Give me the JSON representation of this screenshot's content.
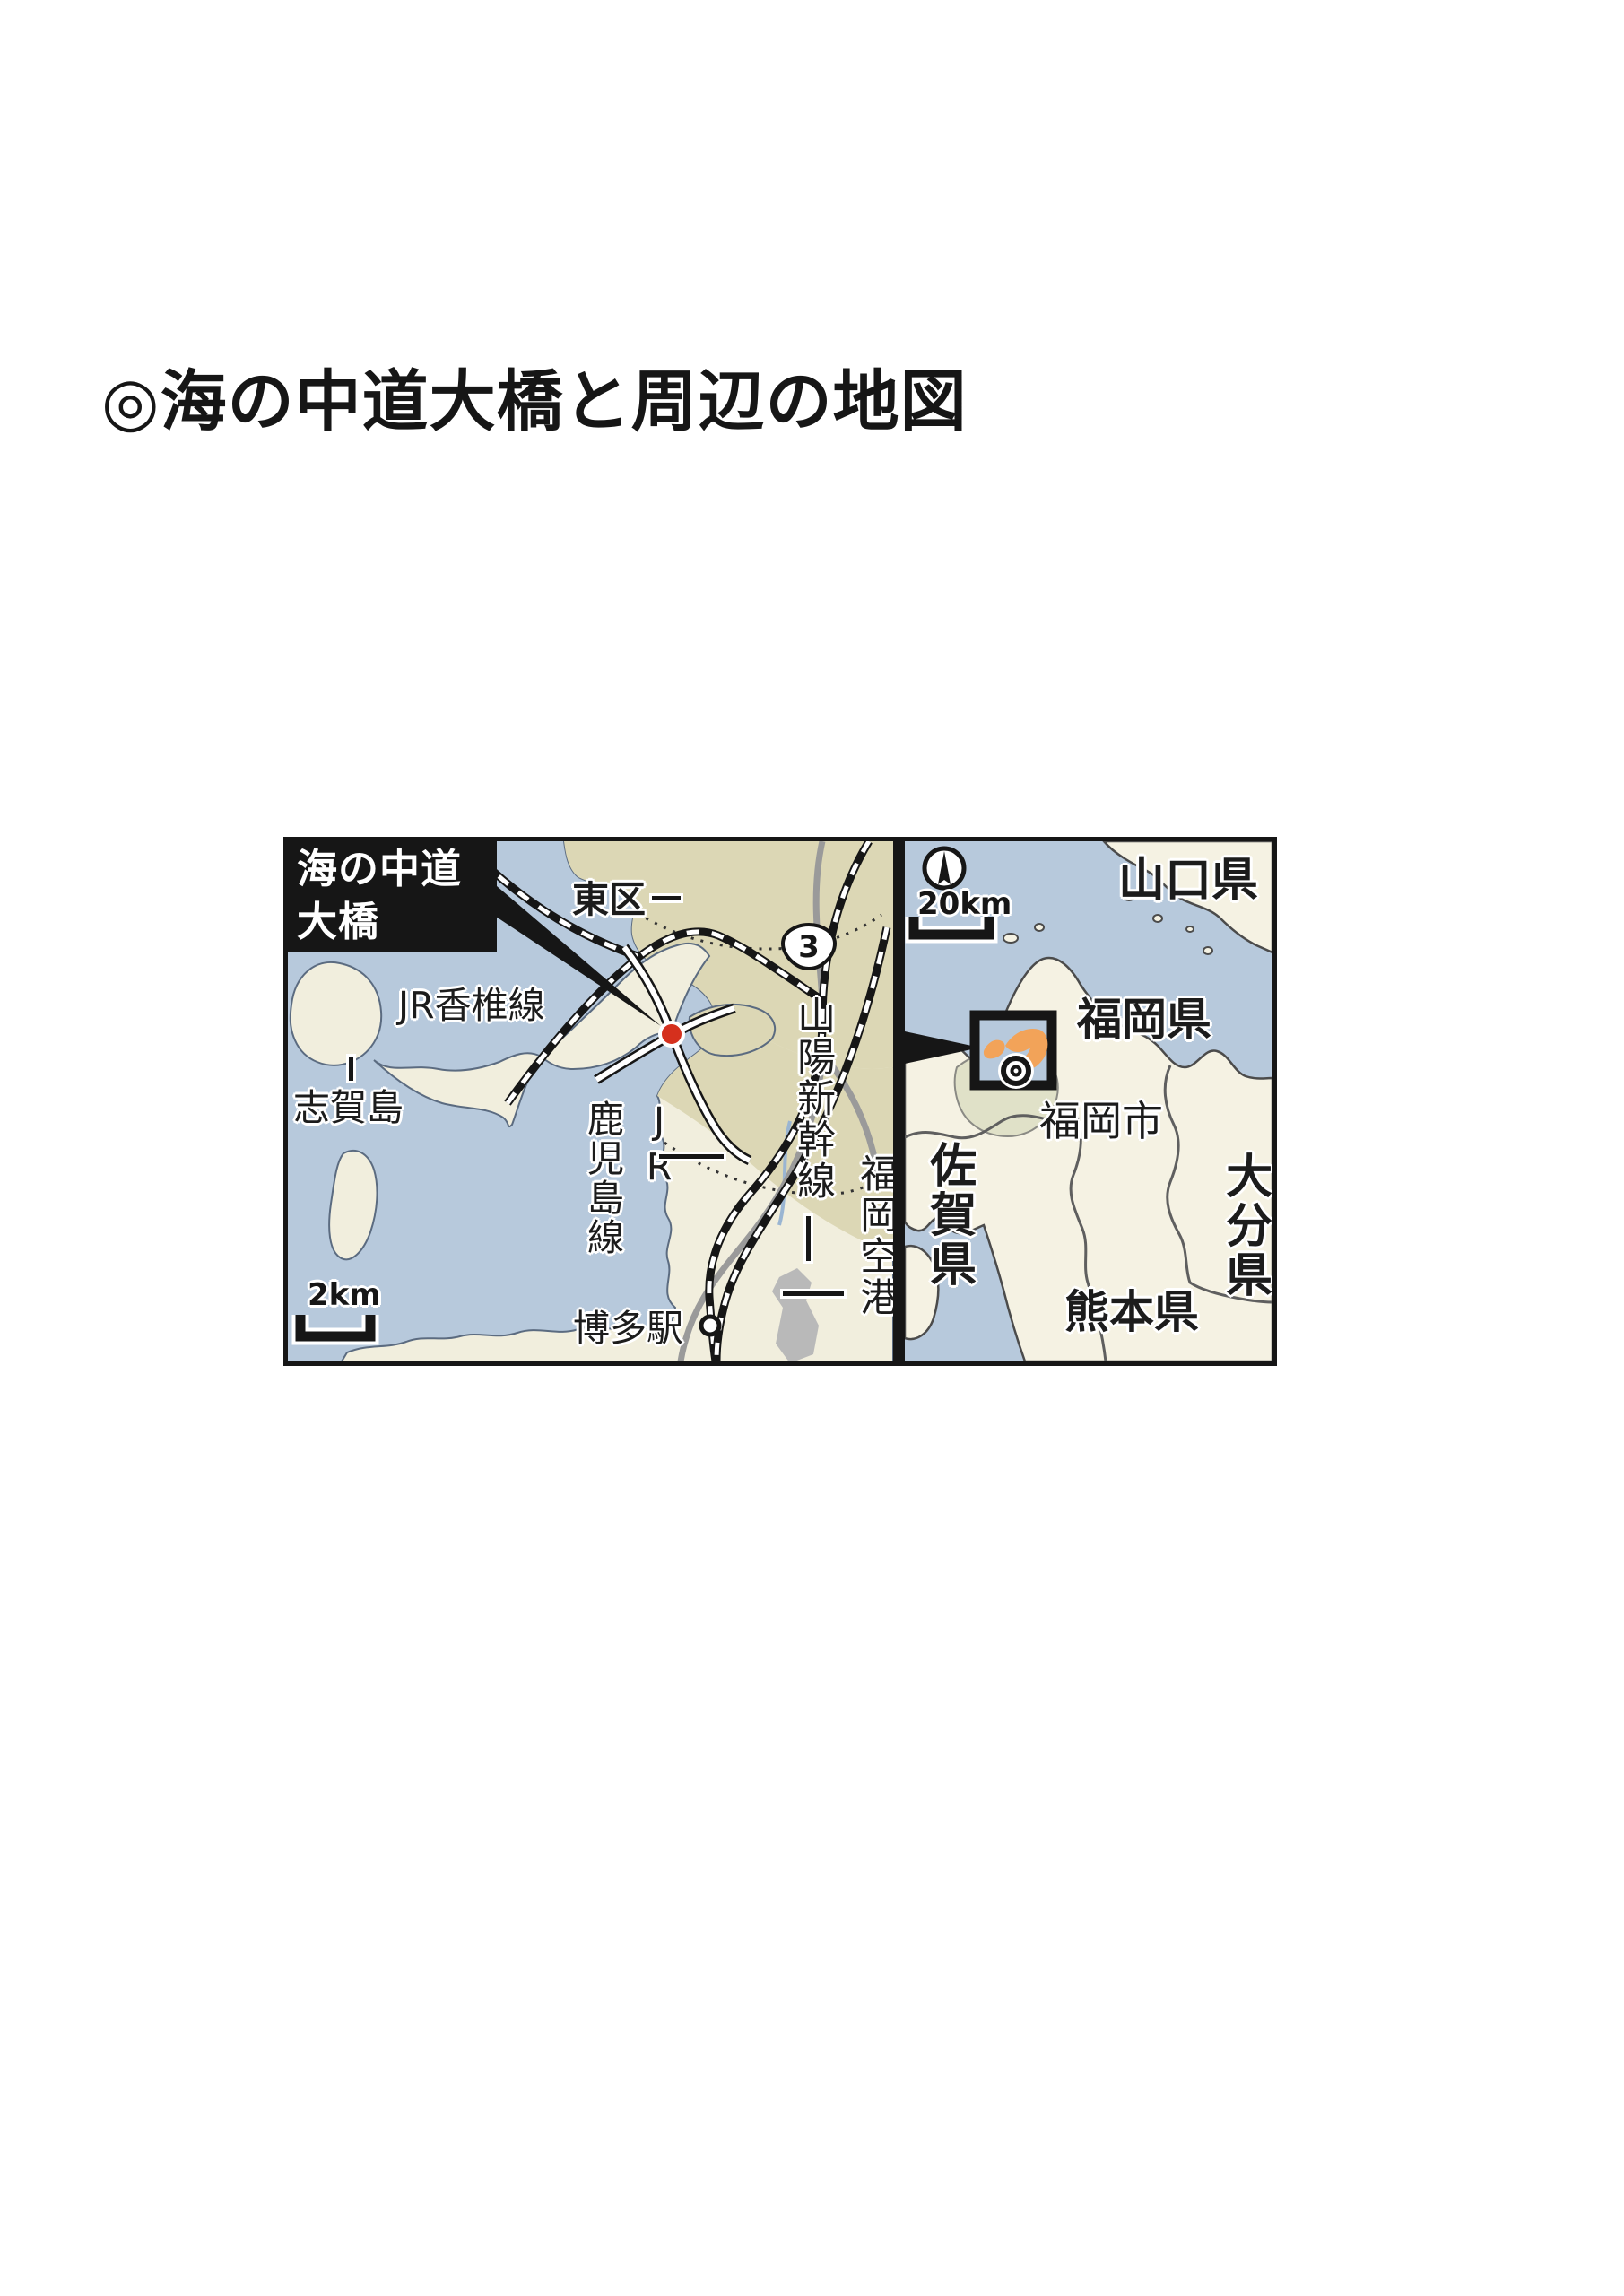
{
  "page": {
    "title": "◎海の中道大橋と周辺の地図"
  },
  "map": {
    "detail_panel": {
      "bridge_label": "海の中道\n大橋",
      "labels": {
        "higashi_ward": "東区",
        "jr_kashii_line": "JR香椎線",
        "shikanoshima": "志賀島",
        "jr_kagoshima_line": "JR\n鹿児島線",
        "hakata_station": "博多駅",
        "sanyo_shinkansen": "山陽新幹線",
        "fukuoka_airport": "福岡空港",
        "route_number": "3"
      },
      "scale": "2km"
    },
    "overview_panel": {
      "labels": {
        "yamaguchi_pref": "山口県",
        "fukuoka_pref": "福岡県",
        "fukuoka_city": "福岡市",
        "saga_pref": "佐賀県",
        "oita_pref": "大分県",
        "kumamoto_pref": "熊本県"
      },
      "scale": "20km"
    },
    "icons": {
      "compass": "north-compass-icon",
      "city_marker": "double-circle-city-marker",
      "bridge_marker": "red-dot-marker",
      "station_marker": "station-circle"
    },
    "colors": {
      "sea": "#b7c9dc",
      "land": "#f1eedd",
      "urban": "#dcd7b5",
      "land_overview": "#f5f2e3",
      "city_area": "#e0e1c8",
      "highlight": "#f2a359",
      "marker": "#d5301d",
      "airport": "#b9b9b9",
      "ink": "#1a1a1a"
    }
  }
}
